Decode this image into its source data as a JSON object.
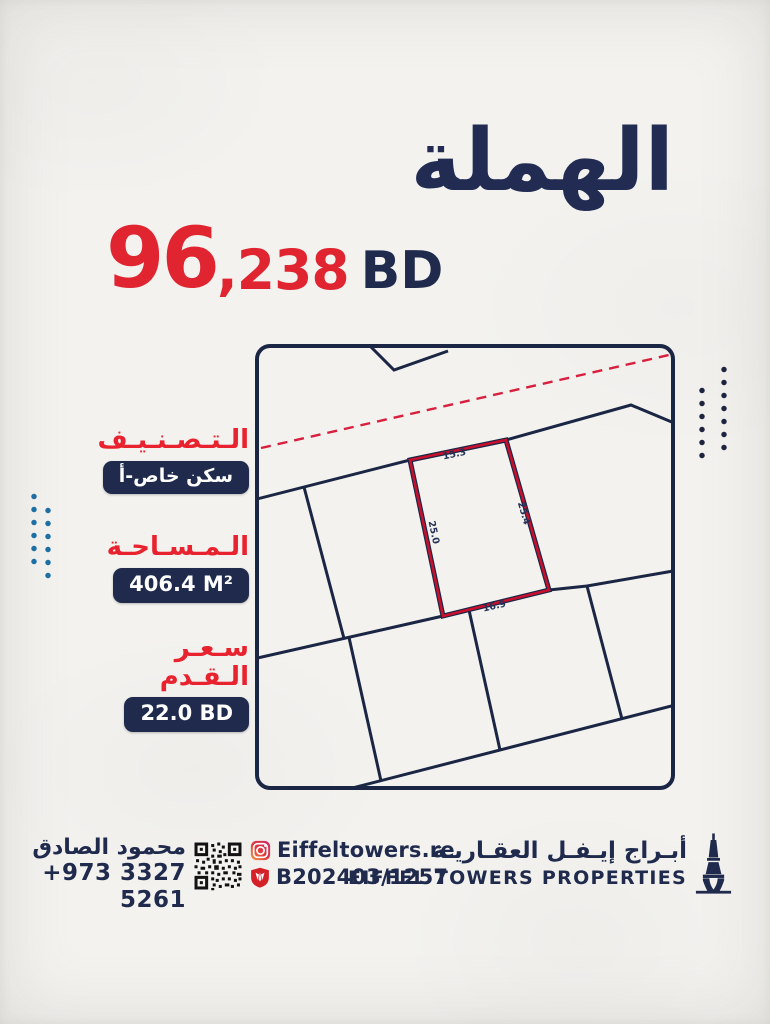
{
  "title": "الهملة",
  "price": {
    "amount_main": "96",
    "amount_fraction": ",238",
    "currency": "BD",
    "full": "96,238 BD"
  },
  "specs": [
    {
      "label": "الـتـصـنـيـف",
      "value": "سكن خاص-أ"
    },
    {
      "label": "الـمـسـاحـة",
      "value": "406.4 M²"
    },
    {
      "label": "سـعـر الـقـدم",
      "value": "22.0 BD"
    }
  ],
  "plot_map": {
    "highlight_dimensions": {
      "top": "15.3",
      "right": "25.4",
      "left": "25.0",
      "bottom": "16.9"
    },
    "highlight_color": "#c8102e",
    "line_color": "#1b2644",
    "road_dash_color": "#d81f3d"
  },
  "footer": {
    "agent_name": "محمود الصادق",
    "agent_phone": "+973 3327 5261",
    "instagram_handle": "Eiffeltowers.re",
    "license_number": "B202403/1257",
    "company_name_ar": "أبـراج إيـفـل العقـاريـة",
    "company_name_en": "EIFFEL TOWERS PROPERTIES",
    "icons": [
      "qr-code",
      "instagram-icon",
      "shield-icon",
      "eiffel-tower-icon"
    ]
  },
  "colors": {
    "navy": "#1f2a4c",
    "red": "#e02531",
    "dots_blue": "#1d6fa3",
    "dots_navy": "#1c2440",
    "background": "#f3f2ef"
  }
}
